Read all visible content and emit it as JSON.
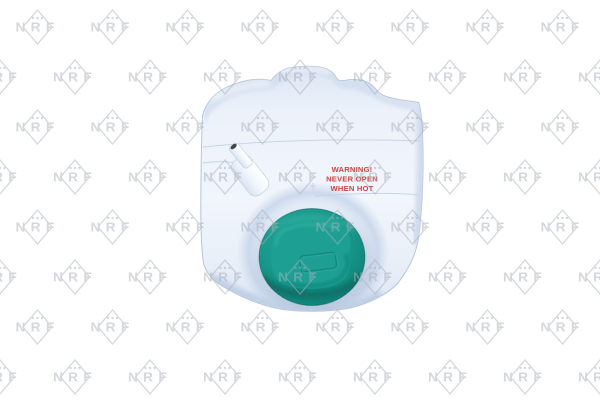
{
  "meta": {
    "description": "Product photo of an NRF automotive coolant expansion tank with teal screw cap on white background with repeating NRF brand watermark",
    "background": "#ffffff"
  },
  "brand": {
    "name": "NRF",
    "watermark_text": "NRF"
  },
  "warning": {
    "line1": "WARNING!",
    "line2": "NEVER OPEN",
    "line3": "WHEN HOT"
  },
  "colors": {
    "watermark_gray": "#a9aeb9",
    "tank_light": "#f0f4fb",
    "tank_shade": "#c9d7eb",
    "tank_outline": "#b7c4d9",
    "cap_light": "#2aab9c",
    "cap_mid": "#18988b",
    "cap_dark": "#0d7c72",
    "cap_deep": "#0a6c63",
    "warning_red": "#cc4545",
    "nozzle_hole": "#42474e"
  }
}
